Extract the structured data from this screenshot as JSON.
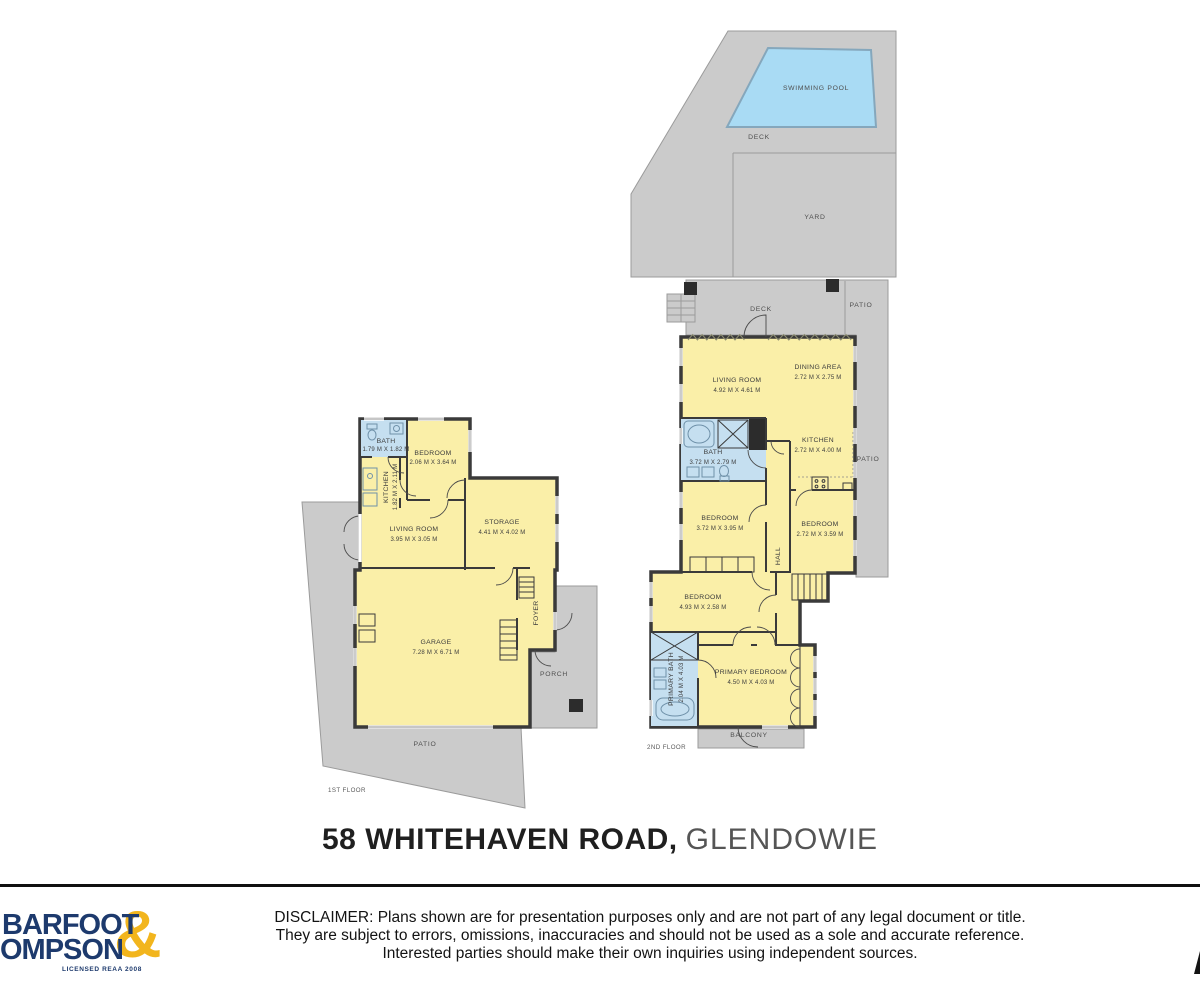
{
  "title": {
    "address": "58 WHITEHAVEN ROAD,",
    "suburb": "GLENDOWIE"
  },
  "colors": {
    "room_fill": "#faefa8",
    "wet_room_fill": "#c5dff0",
    "outdoor_fill": "#cbcbcb",
    "pool_fill": "#a9dbf4",
    "wall": "#3a3a3a",
    "logo_navy": "#1d3a6d",
    "logo_gold": "#f2b51d"
  },
  "plan": {
    "second_floor": {
      "floor_label": "2ND FLOOR",
      "outdoor": {
        "swimming_pool": "SWIMMING POOL",
        "deck_top": "DECK",
        "yard": "YARD",
        "deck": "DECK",
        "patio_top": "PATIO",
        "patio_side": "PATIO",
        "balcony": "BALCONY"
      },
      "rooms": [
        {
          "name": "LIVING ROOM",
          "dims": "4.92 M X 4.61 M"
        },
        {
          "name": "DINING AREA",
          "dims": "2.72 M X 2.75 M"
        },
        {
          "name": "KITCHEN",
          "dims": "2.72 M X 4.00 M"
        },
        {
          "name": "BATH",
          "dims": "3.72 M X 2.79 M"
        },
        {
          "name": "BEDROOM",
          "dims": "3.72 M X 3.95 M"
        },
        {
          "name": "BEDROOM",
          "dims": "2.72 M X 3.59 M"
        },
        {
          "name": "HALL",
          "dims": ""
        },
        {
          "name": "BEDROOM",
          "dims": "4.93 M X 2.58 M"
        },
        {
          "name": "PRIMARY BATH",
          "dims": "2.04 M X 4.03 M"
        },
        {
          "name": "PRIMARY BEDROOM",
          "dims": "4.50 M X 4.03 M"
        }
      ]
    },
    "first_floor": {
      "floor_label": "1ST FLOOR",
      "outdoor": {
        "patio": "PATIO",
        "porch": "PORCH"
      },
      "rooms": [
        {
          "name": "BATH",
          "dims": "1.79 M X 1.82 M"
        },
        {
          "name": "BEDROOM",
          "dims": "2.06 M X 3.64 M"
        },
        {
          "name": "KITCHEN",
          "dims": "1.82 M X 2.11 M"
        },
        {
          "name": "LIVING ROOM",
          "dims": "3.95 M X 3.05 M"
        },
        {
          "name": "STORAGE",
          "dims": "4.41 M X 4.02 M"
        },
        {
          "name": "GARAGE",
          "dims": "7.28 M X 6.71 M"
        },
        {
          "name": "FOYER",
          "dims": ""
        }
      ]
    }
  },
  "footer": {
    "logo": {
      "line1": "BARFOOT",
      "line2": "OMPSON",
      "amp": "&",
      "license": "LICENSED REAA 2008"
    },
    "disclaimer": [
      "DISCLAIMER: Plans shown are for presentation purposes only and are not part of any legal document or title.",
      "They are subject to errors, omissions, inaccuracies and should not be used as a sole and accurate reference.",
      "Interested parties should make their own inquiries using independent sources."
    ]
  }
}
